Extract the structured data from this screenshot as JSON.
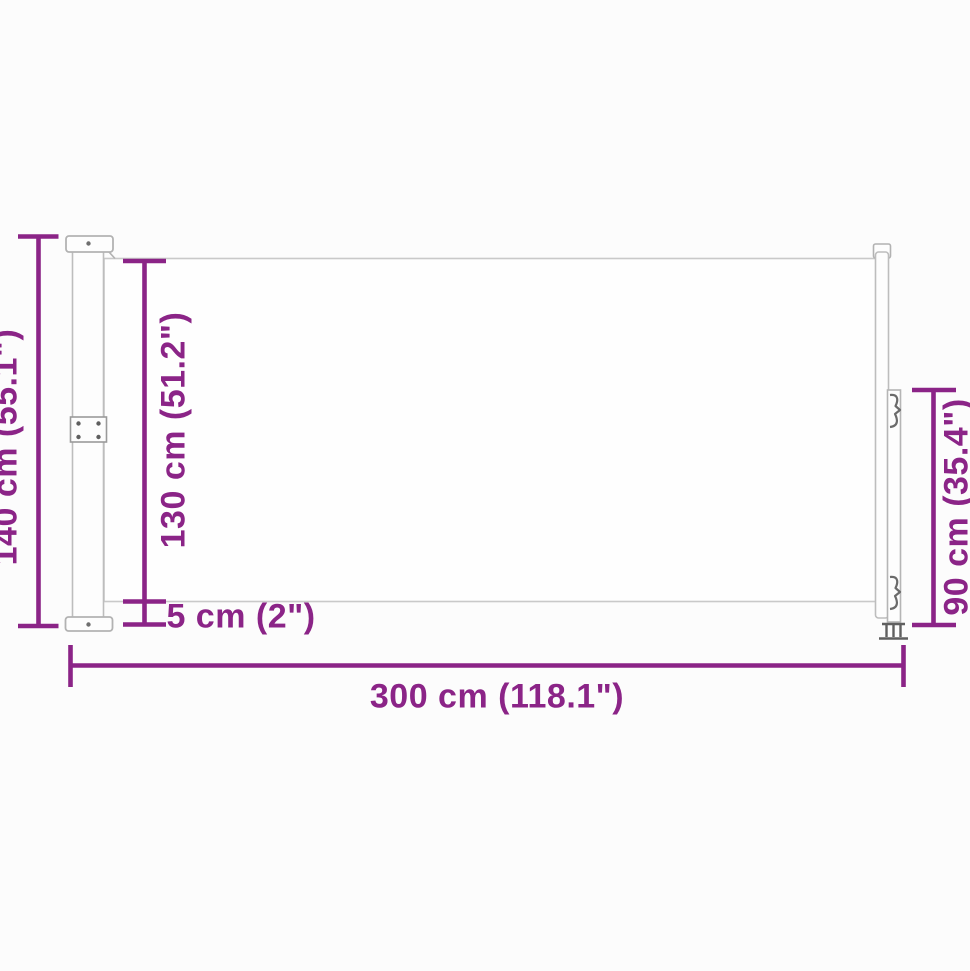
{
  "diagram": {
    "dimensions": {
      "total_height": "140 cm (55.1\")",
      "fabric_height": "130 cm (51.2\")",
      "bottom_gap": "5 cm (2\")",
      "total_length": "300 cm (118.1\")",
      "post_height": "90 cm (35.4\")"
    },
    "colors": {
      "dimension_accent": "#8b2487",
      "drawing_outline": "#bdbdbd",
      "background": "#fcfcfc"
    }
  }
}
